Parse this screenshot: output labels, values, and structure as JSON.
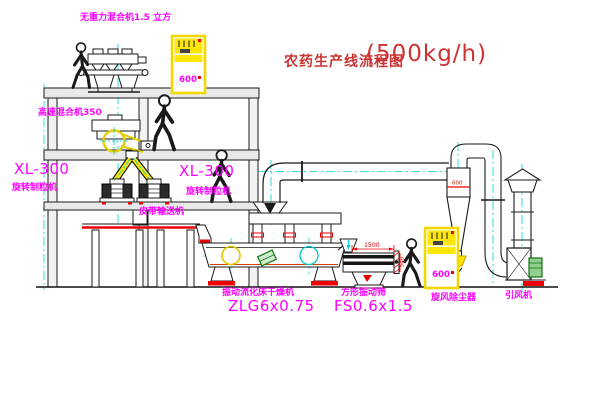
{
  "title": {
    "text": "农药生产线流程图",
    "capacity": "(500kg/h)"
  },
  "machines": {
    "gravity_mixer": {
      "label": "无重力混合机1.5 立方"
    },
    "high_speed_mixer": {
      "label": "高速混合机350"
    },
    "granulator_left": {
      "model": "XL-300",
      "name": "旋转制粒机"
    },
    "granulator_right": {
      "model": "XL-300",
      "name": "旋转制粒机"
    },
    "belt_conveyor": {
      "label": "皮带输送机"
    },
    "fluid_bed_dryer": {
      "name": "振动流化床干燥机",
      "model": "ZLG6x0.75"
    },
    "vibrating_sieve": {
      "name": "方形振动筛",
      "model": "FS0.6x1.5",
      "dim_width": "1500",
      "dim_height": "540"
    },
    "cyclone": {
      "label": "旋风除尘器",
      "dim": "600"
    },
    "fan": {
      "label": "引风机"
    },
    "control_cabinet_1": {
      "text": "600"
    },
    "control_cabinet_2": {
      "text": "600"
    }
  },
  "colors": {
    "label_magenta": "#ff00ff",
    "title_red": "#cc3333",
    "cad_red": "#ee0000",
    "cad_yellow": "#ffe600",
    "cad_cyan": "#00cccc",
    "cad_green": "#2e8b2e"
  }
}
